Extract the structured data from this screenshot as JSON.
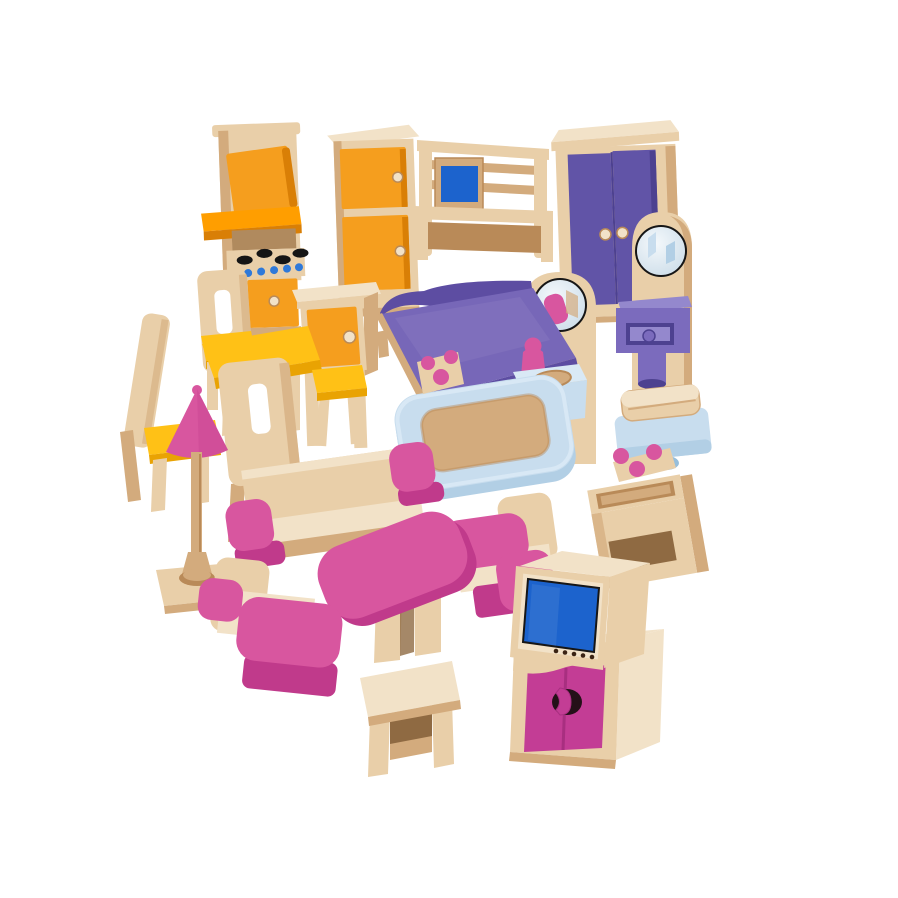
{
  "scene": {
    "type": "product-photo",
    "subject": "Wooden dollhouse furniture set of 25 pieces on a white background",
    "background": "#ffffff",
    "items": [
      {
        "id": "kitchen-stove",
        "label": "kitchen stove with hob and oven",
        "colors": [
          "wood",
          "orange"
        ]
      },
      {
        "id": "refrigerator",
        "label": "two-door refrigerator cabinet",
        "colors": [
          "wood",
          "orange"
        ]
      },
      {
        "id": "cot",
        "label": "child's cot with rails and blue panel",
        "colors": [
          "wood",
          "blue"
        ]
      },
      {
        "id": "wardrobe",
        "label": "double-door wardrobe",
        "colors": [
          "wood",
          "purple"
        ]
      },
      {
        "id": "dressing-table",
        "label": "dressing table with round mirror and purple drawer",
        "colors": [
          "wood",
          "purple"
        ]
      },
      {
        "id": "mirror-washstand-panel",
        "label": "arched mirror panel",
        "colors": [
          "wood"
        ]
      },
      {
        "id": "dining-chair-back",
        "label": "dining chair with cut-out back",
        "colors": [
          "wood",
          "yellow"
        ]
      },
      {
        "id": "dining-chair-left",
        "label": "dining chair with yellow seat",
        "colors": [
          "wood",
          "yellow"
        ]
      },
      {
        "id": "double-bed",
        "label": "double bed with purple cover",
        "colors": [
          "wood",
          "purple"
        ]
      },
      {
        "id": "bedside-cabinet",
        "label": "bedside cabinet with orange door",
        "colors": [
          "wood",
          "orange"
        ]
      },
      {
        "id": "dining-table",
        "label": "yellow dining table",
        "colors": [
          "wood",
          "yellow"
        ]
      },
      {
        "id": "kitchen-stool",
        "label": "stool with yellow seat",
        "colors": [
          "wood",
          "yellow"
        ]
      },
      {
        "id": "dining-chair-rear",
        "label": "dining chair seen from behind",
        "colors": [
          "wood"
        ]
      },
      {
        "id": "pedestal-sink",
        "label": "pedestal wash basin with pink tap figure",
        "colors": [
          "light-blue",
          "pink"
        ]
      },
      {
        "id": "bathtub",
        "label": "bathtub with wooden basin and pink taps",
        "colors": [
          "light-blue",
          "wood",
          "pink"
        ]
      },
      {
        "id": "toilet",
        "label": "toilet with wooden lid",
        "colors": [
          "light-blue",
          "wood"
        ]
      },
      {
        "id": "washstand",
        "label": "wooden washstand with pink taps",
        "colors": [
          "wood",
          "pink"
        ]
      },
      {
        "id": "floor-lamp",
        "label": "floor lamp with pink cone shade",
        "colors": [
          "wood",
          "pink"
        ]
      },
      {
        "id": "sofa",
        "label": "sofa with pink armrests",
        "colors": [
          "wood",
          "pink"
        ]
      },
      {
        "id": "armchair-right",
        "label": "armchair with pink armrests (right)",
        "colors": [
          "wood",
          "pink"
        ]
      },
      {
        "id": "tv-cabinet",
        "label": "TV cabinet with magenta doors",
        "colors": [
          "wood",
          "magenta"
        ]
      },
      {
        "id": "television",
        "label": "television with blue screen",
        "colors": [
          "wood",
          "blue"
        ]
      },
      {
        "id": "coffee-table",
        "label": "pink coffee table",
        "colors": [
          "pink",
          "wood"
        ]
      },
      {
        "id": "armchair-left",
        "label": "armchair with pink armrests (left)",
        "colors": [
          "wood",
          "pink"
        ]
      },
      {
        "id": "wooden-stool",
        "label": "small wooden side stool",
        "colors": [
          "wood"
        ]
      }
    ]
  },
  "palette": {
    "bg": "#ffffff",
    "wood-pale": "#f2e2c8",
    "wood-light": "#e9cfa9",
    "wood-mid": "#d3ab7d",
    "wood-dark": "#b98a58",
    "wood-deep": "#8f6a42",
    "orange": "#f59e1e",
    "orange-dark": "#d97f06",
    "orange-bright": "#ff9e00",
    "yellow": "#ffc116",
    "yellow-dark": "#e9a303",
    "purple": "#6154a7",
    "purple-dark": "#4d4190",
    "purple-light": "#7b6bbd",
    "purple-lighter": "#9488cd",
    "bed-purple": "#7767b8",
    "bed-purple-dark": "#5d4da2",
    "pink": "#d8569f",
    "pink-dark": "#c03a8b",
    "magenta": "#c33d95",
    "magenta-deep": "#a82f80",
    "screen-blue": "#1c63cd",
    "dot-blue": "#2f79d9",
    "lt-blue": "#c8ddee",
    "lt-blue-light": "#d9e9f5",
    "lt-blue-mid": "#b2cfe5",
    "lt-blue-dark": "#96bedb",
    "mirror-hi": "#f4f8fb",
    "mirror-lo": "#ccdde9",
    "ink": "#161616",
    "burner-black": "#151515",
    "keyhole-black": "#241018"
  }
}
